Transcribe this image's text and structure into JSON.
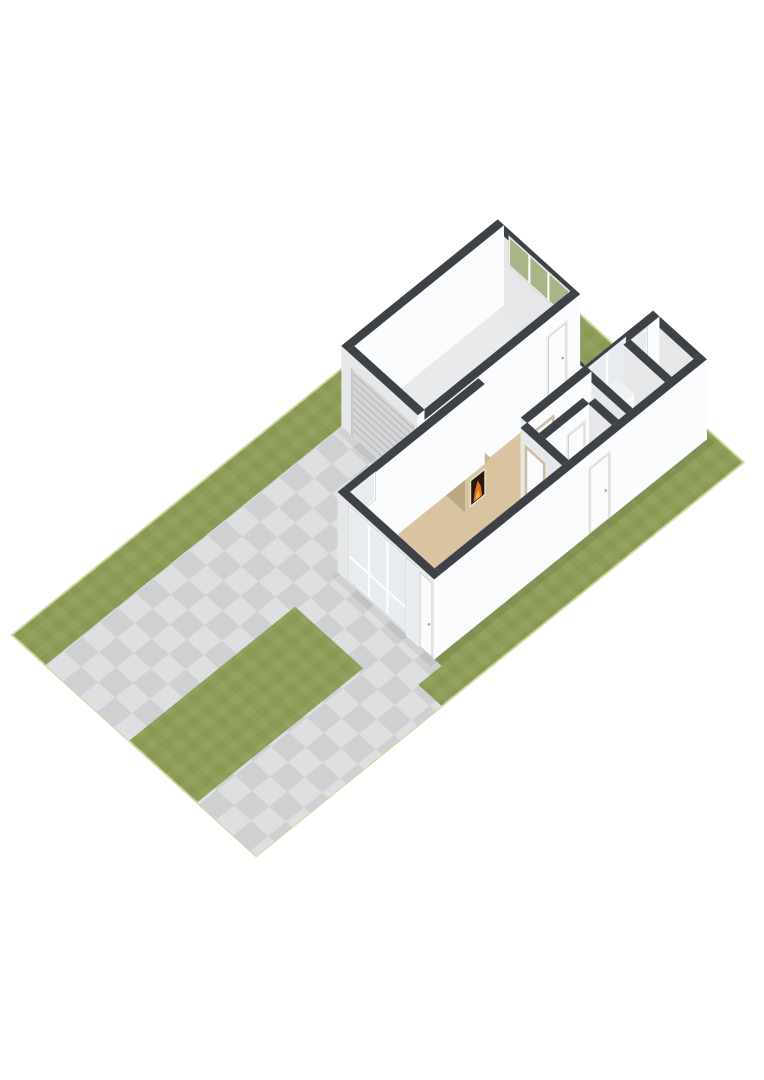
{
  "meta": {
    "description": "3D isometric floor plan render of a single-storey house on a lot with lawn, driveway and paths",
    "background": "#ffffff",
    "canvas": {
      "width": 764,
      "height": 1080
    }
  },
  "scene": {
    "origin": [
      12,
      635
    ],
    "axis_a": [
      0.78,
      -0.63
    ],
    "axis_b": [
      0.74,
      0.67
    ],
    "wall_height": 80,
    "colors": {
      "grass": "#8e9d59",
      "lot_edge": "#cdd79c",
      "paving": "#cfd0d2",
      "wall_top": "#3e4145",
      "wall_sw": "#e6e7e9",
      "wall_se": "#fbfcfd",
      "wall_nw": "#eff0f2",
      "wall_ne": "#f5f6f7",
      "floor_garage": "#e9eaec",
      "floor_living": "#d9c3a0",
      "floor_hall": "#f3f3f4",
      "floor_bath": "#dde4eb",
      "glass": "#e7edef",
      "glass_grass": "#a9b586",
      "frame": "#fdfdfe",
      "frame_line": "#c9cbcd",
      "door_leaf": "#fbfbfc",
      "door_frame_wood": "#cdbb94",
      "door_frame_white": "#eceded",
      "door_stroke": "#c6c8ca",
      "garage_door": "#d5d6d8",
      "garage_door_rib": "#bfc0c2",
      "garage_door_trim": "#c8c9cb",
      "mantel_frame": "#e8ddc4",
      "firebox": "#27190e",
      "flame": "#e4731c",
      "flame_core": "#f7b03c",
      "shadow": "rgba(40,45,50,0.08)",
      "handle": "#adb0b3"
    },
    "palettes": {
      "wall": {
        "nw": "#eff0f2",
        "ne": "#f5f6f7",
        "sw": "#e6e7e9",
        "se": "#fbfcfd",
        "top": "#3e4145"
      },
      "mantel": {
        "nw": "#c4b38e",
        "ne": "#cdbc97",
        "sw": "#b9a883",
        "se": "#d6c5a0",
        "top": "#c9b893"
      },
      "cabinet": {
        "nw": "#f0f2f4",
        "ne": "#f6f7f8",
        "sw": "#e8eaec",
        "se": "#fbfcfd",
        "top": "#eef0f2"
      }
    },
    "ground": {
      "lot": [
        0,
        0,
        625,
        330
      ],
      "paving": [
        {
          "name": "driveway",
          "rect": [
            0,
            45,
            380,
            158
          ]
        },
        {
          "name": "front-apron",
          "rect": [
            213,
            158,
            268,
            298
          ]
        },
        {
          "name": "terrace-connector",
          "rect": [
            248,
            156,
            380,
            213
          ]
        },
        {
          "name": "side-path",
          "rect": [
            0,
            250,
            238,
            330
          ]
        }
      ],
      "shadows": [
        [
          372,
          47,
          380,
          160
        ],
        [
          260,
          158,
          268,
          292
        ],
        [
          268,
          288,
          620,
          296
        ],
        [
          380,
          154,
          450,
          160
        ]
      ]
    },
    "floors": [
      {
        "name": "garage-floor",
        "rect": [
          388,
          53,
          572,
          148
        ],
        "color": "floor_garage"
      },
      {
        "name": "living-room-floor",
        "rect": [
          276,
          166,
          448,
          280
        ],
        "color": "floor_living"
      },
      {
        "name": "dining-floor",
        "rect": [
          448,
          164,
          522,
          216
        ],
        "color": "floor_living"
      },
      {
        "name": "hall-floor",
        "rect": [
          448,
          224,
          522,
          280
        ],
        "color": "floor_hall"
      },
      {
        "name": "bathroom-floor",
        "rect": [
          530,
          224,
          572,
          280
        ],
        "color": "floor_bath"
      },
      {
        "name": "right-room-floor",
        "rect": [
          580,
          224,
          609,
          280
        ],
        "color": "floor_bath"
      }
    ],
    "solids": [
      {
        "name": "garage-nw-wall",
        "rect": [
          380,
          45,
          580,
          53
        ],
        "h": 80
      },
      {
        "name": "garage-ne-wall",
        "rect": [
          572,
          53,
          580,
          148
        ],
        "h": 80,
        "openings": [
          {
            "side": "ne",
            "type": "window",
            "a1": 62,
            "a2": 140,
            "z1": 46,
            "z2": 72,
            "mullions": [
              0.33,
              0.66
            ],
            "glass": "#a9b586"
          }
        ]
      },
      {
        "name": "garage-sw-wall",
        "rect": [
          380,
          53,
          388,
          148
        ],
        "h": 80,
        "openings": [
          {
            "side": "sw",
            "type": "garage-door",
            "a1": 58,
            "a2": 143,
            "z1": 0,
            "z2": 66
          }
        ]
      },
      {
        "name": "garage-se-wall",
        "rect": [
          380,
          148,
          580,
          156
        ],
        "h": 80,
        "openings": [
          {
            "side": "se",
            "type": "door-white",
            "a1": 540,
            "a2": 562,
            "z1": 0,
            "z2": 62
          }
        ]
      },
      {
        "name": "house-nw-wall",
        "rect": [
          268,
          158,
          448,
          166
        ],
        "h": 80,
        "openings": [
          {
            "side": "nw",
            "type": "window",
            "a1": 286,
            "a2": 314,
            "z1": 44,
            "z2": 68
          }
        ]
      },
      {
        "name": "house-nw-wall-mid",
        "rect": [
          448,
          156,
          530,
          164
        ],
        "h": 80
      },
      {
        "name": "dining-ne-window-wall",
        "rect": [
          522,
          156,
          530,
          216
        ],
        "h": 80,
        "openings": [
          {
            "side": "ne",
            "type": "window",
            "a1": 164,
            "a2": 210,
            "z1": 6,
            "z2": 74,
            "mullions": [
              0.5
            ],
            "transom": 24
          }
        ]
      },
      {
        "name": "courtyard-se-window-wall",
        "rect": [
          530,
          216,
          617,
          224
        ],
        "h": 80,
        "openings": [
          {
            "side": "nw",
            "type": "window",
            "a1": 536,
            "a2": 580,
            "z1": 6,
            "z2": 74,
            "mullions": [
              0.5
            ],
            "transom": 24
          },
          {
            "side": "nw",
            "type": "window",
            "a1": 588,
            "a2": 608,
            "z1": 30,
            "z2": 66
          }
        ]
      },
      {
        "name": "house-ne-wall",
        "rect": [
          609,
          224,
          617,
          288
        ],
        "h": 80
      },
      {
        "name": "house-se-wall",
        "rect": [
          268,
          280,
          617,
          288
        ],
        "h": 80,
        "openings": [
          {
            "side": "se",
            "type": "door-white",
            "a1": 468,
            "a2": 492,
            "z1": 0,
            "z2": 64
          }
        ]
      },
      {
        "name": "house-facade-wall",
        "rect": [
          268,
          158,
          276,
          288
        ],
        "h": 80,
        "openings": [
          {
            "side": "sw",
            "type": "window",
            "a1": 174,
            "a2": 250,
            "z1": 4,
            "z2": 74,
            "mullions": [
              0.34,
              0.67
            ],
            "transom": 26
          },
          {
            "side": "sw",
            "type": "window",
            "a1": 252,
            "a2": 266,
            "z1": 0,
            "z2": 74
          },
          {
            "side": "sw",
            "type": "door-white",
            "a1": 269,
            "a2": 285,
            "z1": 0,
            "z2": 74
          }
        ]
      },
      {
        "name": "wall-dining-hall",
        "rect": [
          448,
          216,
          530,
          224
        ],
        "h": 80,
        "openings": [
          {
            "side": "se",
            "type": "door-wood",
            "a1": 458,
            "a2": 480,
            "z1": 0,
            "z2": 64
          }
        ]
      },
      {
        "name": "wall-living-hall",
        "rect": [
          440,
          224,
          448,
          280
        ],
        "h": 80,
        "openings": [
          {
            "side": "sw",
            "type": "door-wood",
            "a1": 232,
            "a2": 254,
            "z1": 0,
            "z2": 64
          }
        ]
      },
      {
        "name": "wall-hall-bathroom",
        "rect": [
          522,
          224,
          530,
          280
        ],
        "h": 80,
        "openings": [
          {
            "side": "sw",
            "type": "door-white",
            "a1": 236,
            "a2": 258,
            "z1": 0,
            "z2": 64
          }
        ]
      },
      {
        "name": "wc-north-wall",
        "rect": [
          448,
          240,
          504,
          248
        ],
        "h": 80,
        "openings": [
          {
            "side": "se",
            "type": "door-white",
            "a1": 478,
            "a2": 498,
            "z1": 0,
            "z2": 64
          }
        ]
      },
      {
        "name": "wc-east-wall",
        "rect": [
          504,
          248,
          512,
          280
        ],
        "h": 80
      },
      {
        "name": "wall-bathroom-partition",
        "rect": [
          572,
          224,
          580,
          280
        ],
        "h": 80
      },
      {
        "name": "fireplace-chimney",
        "rect": [
          402,
          166,
          428,
          186
        ],
        "h": 76
      },
      {
        "name": "fireplace-mantel",
        "rect": [
          399,
          166,
          431,
          192
        ],
        "h": 34,
        "palette": "mantel",
        "fire": true
      },
      {
        "name": "tall-cabinet",
        "rect": [
          538,
          228,
          560,
          250
        ],
        "h": 56,
        "palette": "cabinet"
      }
    ],
    "objects": [
      {
        "name": "toilet",
        "type": "toilet",
        "u": 485,
        "v": 266
      }
    ]
  }
}
